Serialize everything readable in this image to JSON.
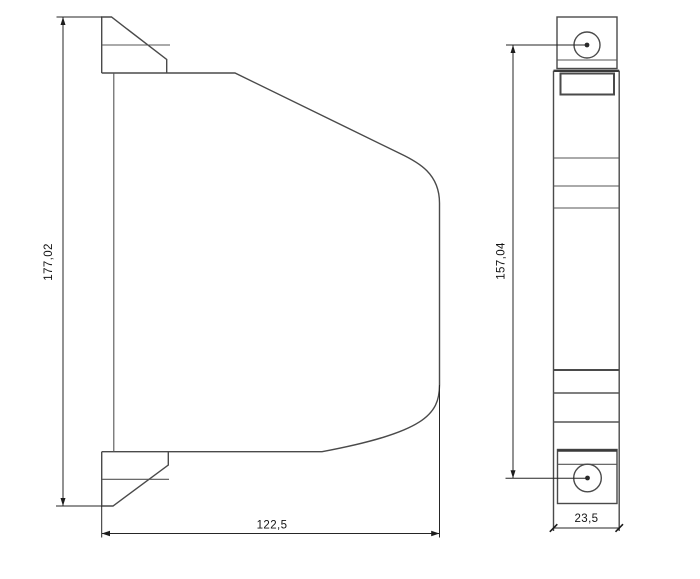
{
  "colors": {
    "background": "#ffffff",
    "part_line": "#4a4a4a",
    "dimension_line": "#262626",
    "text": "#141414"
  },
  "side_view": {
    "height_dim": "177,02",
    "width_dim": "122,5"
  },
  "front_view": {
    "hole_spacing_dim": "157,04",
    "width_dim": "23,5"
  }
}
